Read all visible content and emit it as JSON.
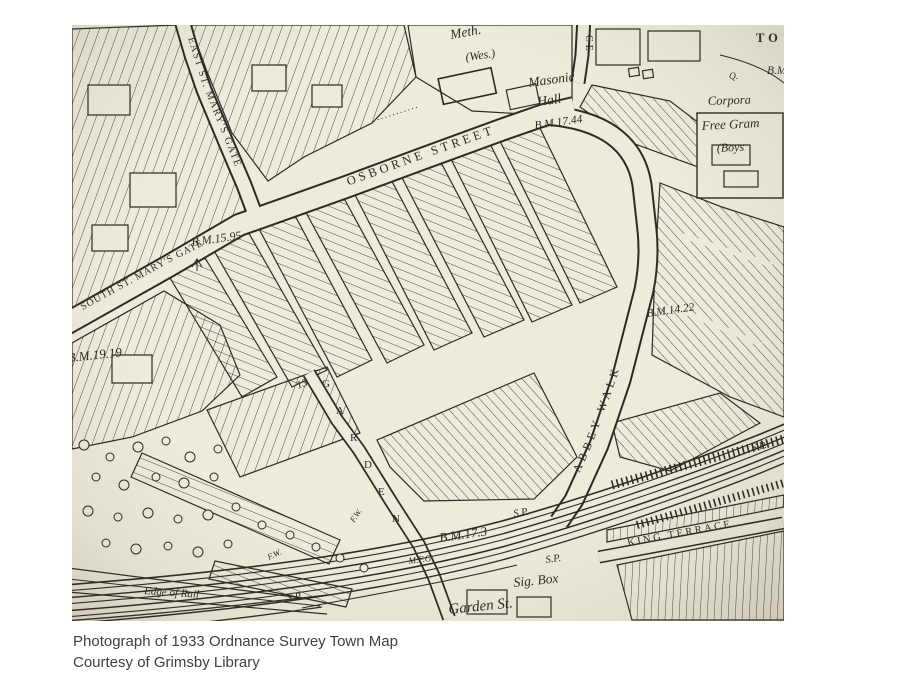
{
  "page": {
    "background": "#ffffff"
  },
  "photo": {
    "paper_color": "#f1eede",
    "ink_color": "#2b2722"
  },
  "map_labels": {
    "meth": "Meth.",
    "wes": "(Wes.)",
    "masonic_line1": "Masonic",
    "masonic_line2": "Hall",
    "ce_street": "CE",
    "to_fragment": "TO",
    "bm_fragment": "B.M",
    "corporation": "Corpora",
    "free_grammar": "Free Gram",
    "boys": "(Boys",
    "east_st_marys_gate": "EAST ST. MARY'S GATE",
    "south_st_marys_gate": "SOUTH ST. MARY'S GATE",
    "osborne_street": "OSBORNE STREET",
    "abbey_walk": "ABBEY WALK",
    "garden_vertical": "GARDEN",
    "garden_st": "Garden St.",
    "king_terrace": "KING TERRACE",
    "sig_box": "Sig. Box",
    "edge_of_rail": "Edge of Rail",
    "bm_17_44": "B.M.17.44",
    "bm_15_95": "B.M.15.95",
    "bm_19_19": "B.M.19.19",
    "bm_14_22": "B.M.14.22",
    "bm_17_3": "B.M.17.3",
    "sp": "S.P.",
    "fw": "F.W.",
    "mfg": "M.F.G.",
    "q": "Q.",
    "house_13": "13"
  },
  "caption": {
    "line1": "Photograph of 1933 Ordnance Survey Town Map",
    "line2": "Courtesy of Grimsby Library"
  }
}
